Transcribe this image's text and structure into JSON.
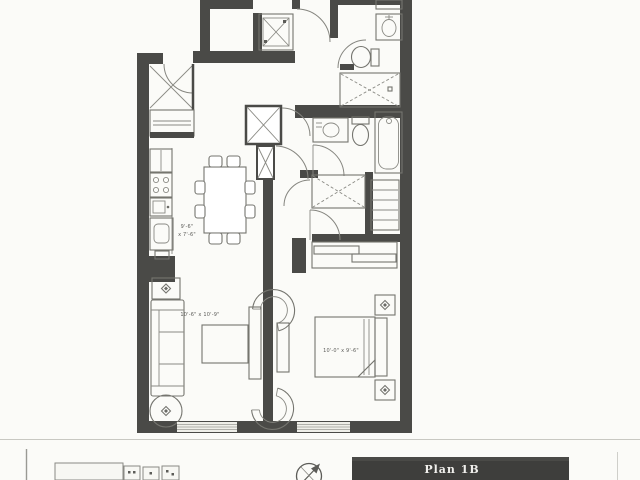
{
  "page": {
    "background": "#fbfbf8",
    "rule_color": "#c8c8c2"
  },
  "plan": {
    "title": "Plan 1B",
    "title_bar_color": "#3e3e3c",
    "title_text_color": "#f0efec",
    "wall_color": "#4a4a47",
    "fixture_line_color": "#75756f"
  },
  "rooms": {
    "living": {
      "dimensions": "10'-6\" x 10'-9\""
    },
    "bedroom": {
      "dimensions": "10'-0\" x 9'-6\""
    },
    "kitchen": {
      "dim_line1": "9'-6\"",
      "dim_line2": "x 7'-6\""
    }
  },
  "icons": {
    "north_arrow": "compass-north-arrow",
    "key_plan": "building-footprint-key-plan"
  }
}
